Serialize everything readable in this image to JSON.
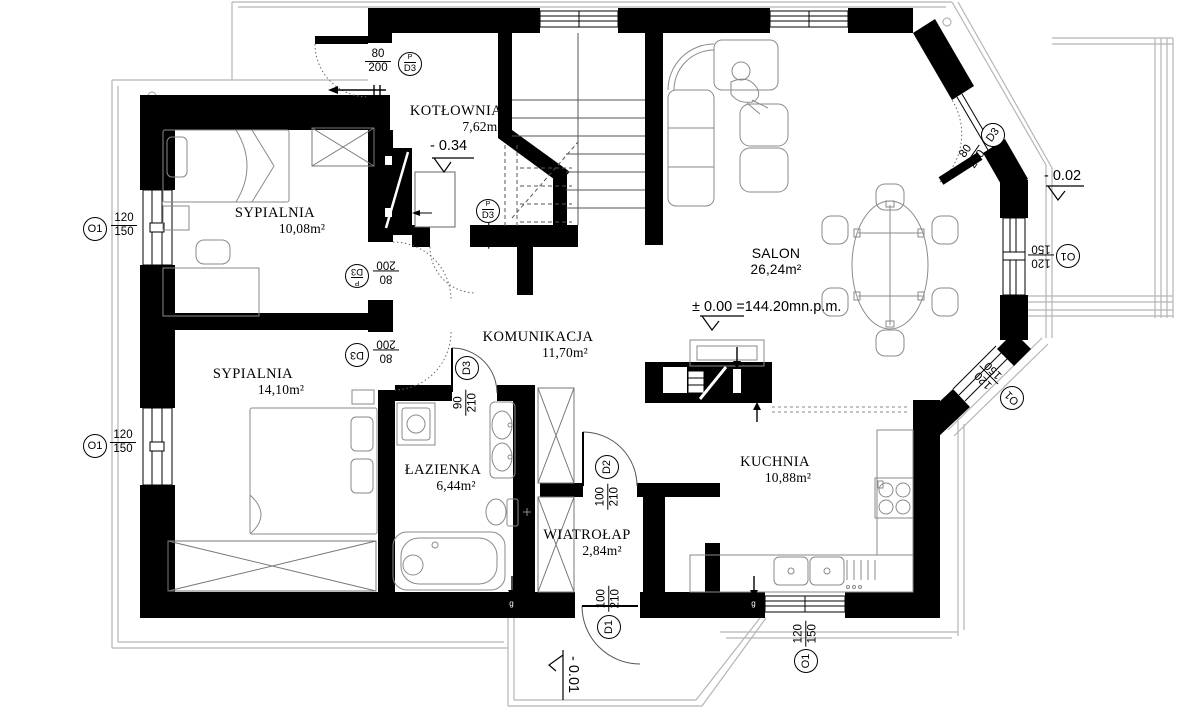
{
  "plan": {
    "rooms": [
      {
        "name": "KOTŁOWNIA",
        "area": "7,62m²"
      },
      {
        "name": "SYPIALNIA",
        "area": "10,08m²"
      },
      {
        "name": "SYPIALNIA",
        "area": "14,10m²"
      },
      {
        "name": "KOMUNIKACJA",
        "area": "11,70m²"
      },
      {
        "name": "ŁAZIENKA",
        "area": "6,44m²"
      },
      {
        "name": "WIATROŁAP",
        "area": "2,84m²"
      },
      {
        "name": "SALON",
        "area": "26,24m²"
      },
      {
        "name": "KUCHNIA",
        "area": "10,88m²"
      }
    ],
    "doors": [
      {
        "tag": "D3",
        "top": "P",
        "dims": {
          "w": "80",
          "h": "200"
        }
      },
      {
        "tag": "D3",
        "top": "P",
        "dims": {
          "w": "80",
          "h": "200"
        }
      },
      {
        "tag": "D3",
        "top": "P",
        "dims": {
          "w": "80",
          "h": "200"
        }
      },
      {
        "tag": "D3",
        "dims": {
          "w": "80",
          "h": "200"
        }
      },
      {
        "tag": "D3",
        "dims": {
          "w": "90",
          "h": "210"
        }
      },
      {
        "tag": "D2",
        "dims": {
          "w": "100",
          "h": "210"
        }
      },
      {
        "tag": "D1",
        "dims": {
          "w": "100",
          "h": "210"
        }
      },
      {
        "tag": "D3",
        "dims": {
          "w": "80",
          "h": "200"
        }
      }
    ],
    "windows": [
      {
        "tag": "O1",
        "dims": {
          "w": "120",
          "h": "150"
        }
      },
      {
        "tag": "O1",
        "dims": {
          "w": "120",
          "h": "150"
        }
      },
      {
        "tag": "O1",
        "dims": {
          "w": "120",
          "h": "150"
        }
      },
      {
        "tag": "O1",
        "dims": {
          "w": "120",
          "h": "150"
        }
      },
      {
        "tag": "O1",
        "dims": {
          "w": "120",
          "h": "150"
        }
      }
    ],
    "levels": [
      {
        "value": "- 0.34"
      },
      {
        "value": "± 0.00 =144.20mn.p.m."
      },
      {
        "value": "- 0.02"
      },
      {
        "value": "- 0.01"
      }
    ],
    "markers": [
      {
        "label": "g"
      },
      {
        "label": "g"
      }
    ]
  }
}
